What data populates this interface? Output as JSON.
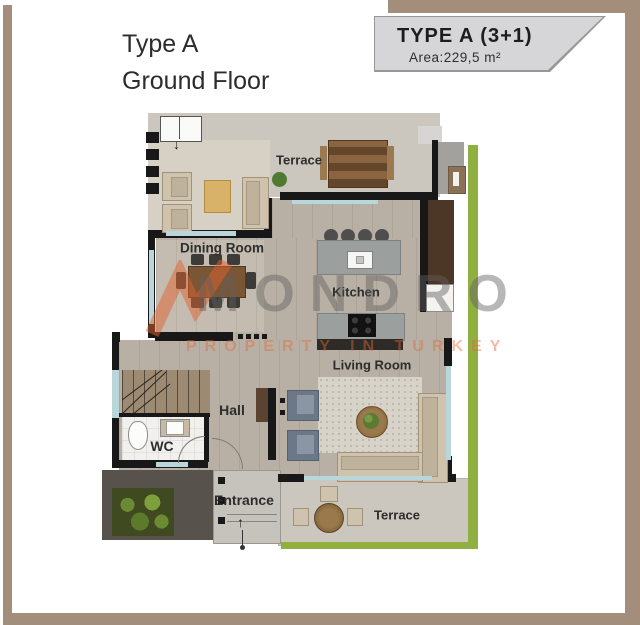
{
  "title": {
    "line1": "Type A",
    "line2": "Ground Floor"
  },
  "badge": {
    "type": "TYPE A (3+1)",
    "area": "Area:229,5 m²"
  },
  "rooms": {
    "terrace_top": "Terrace",
    "dining_room": "Dining Room",
    "kitchen": "Kitchen",
    "living_room": "Living Room",
    "hall": "Hall",
    "wc": "WC",
    "entrance": "Entrance",
    "terrace_bottom": "Terrace"
  },
  "watermark": {
    "brand": "MONDRO",
    "tagline": "PROPERTY IN TURKEY"
  },
  "icons": {
    "entry_arrow": "↓",
    "entrance_arrow": "↑"
  },
  "colors": {
    "frame": "#a28e7b",
    "badge_bg": "#d6d6d8",
    "wall": "#181818",
    "wood_floor": "#b8b0a4",
    "terrace_floor": "#cbc7bf",
    "grass": "#8fb041",
    "window_glass": "#b9d6da",
    "cabinet_brown": "#4c3626",
    "watermark_gray": "#5f5f5f",
    "watermark_orange": "#e06a38"
  }
}
